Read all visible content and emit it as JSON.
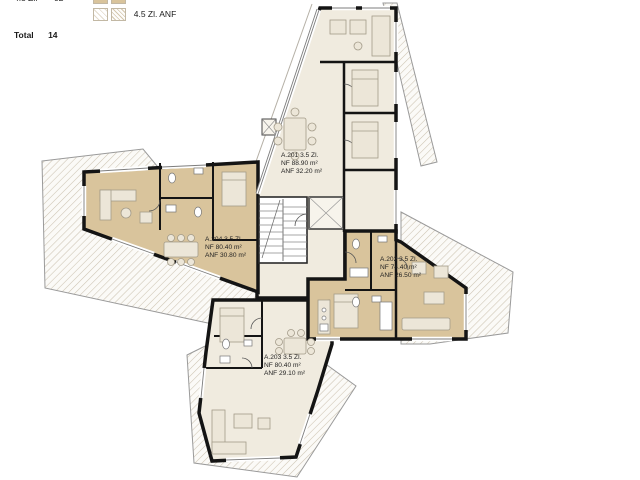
{
  "legend": {
    "unit_rows": [
      {
        "label": "4.5 Zl.",
        "count": "02"
      }
    ],
    "total": {
      "label": "Total",
      "value": "14"
    },
    "swatch_rows": [
      {
        "label": "4.5 Zl.",
        "style": "solid-tan"
      },
      {
        "label": "4.5 Zl. ANF",
        "style": "diagonal-hatch"
      }
    ]
  },
  "apartments": [
    {
      "name": "A.201",
      "line1": "A.201  3.5 Zl.",
      "line2": "NF 88.90 m²",
      "line3": "ANF 32.20 m²"
    },
    {
      "name": "A.202",
      "line1": "A.202  3.5 Zl.",
      "line2": "NF 74.40 m²",
      "line3": "ANF 26.50 m²"
    },
    {
      "name": "A.203",
      "line1": "A.203  3.5 Zl.",
      "line2": "NF 80.40 m²",
      "line3": "ANF 29.10 m²"
    },
    {
      "name": "A.204",
      "line1": "A.204  3.5 Zl.",
      "line2": "NF 80.40 m²",
      "line3": "ANF 30.80 m²"
    }
  ],
  "colors": {
    "apartment_tan": "#d9c49c",
    "room_cream": "#f0ebdf",
    "hatch_line": "#cdc4b2",
    "wall": "#141414"
  }
}
